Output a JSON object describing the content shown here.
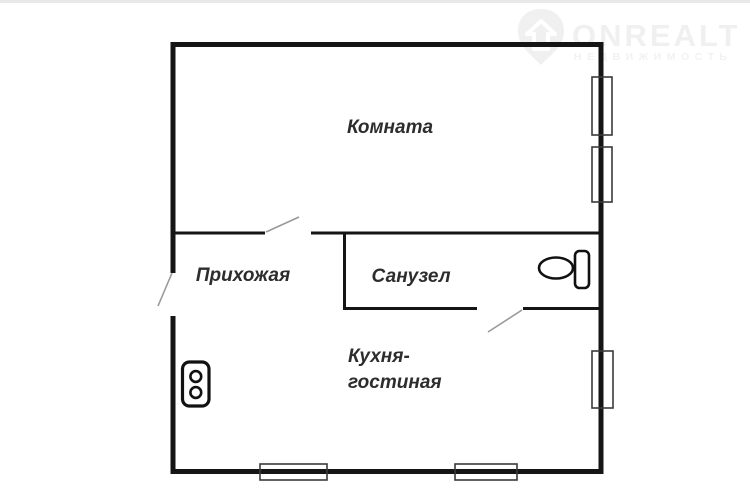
{
  "page": {
    "background": "#ffffff",
    "wall_color": "#151515",
    "door_leaf_color": "#999999",
    "window_outline_color": "#3a3a3a",
    "label_color": "#2d2d2d",
    "watermark_color": "#f0f0f0"
  },
  "watermark": {
    "brand": "ONREALT",
    "tagline": "НЕДВИЖИМОСТЬ",
    "icon": "shield-home-icon"
  },
  "floorplan": {
    "type": "apartment-floor-plan",
    "rooms": [
      {
        "id": "komnata",
        "label": "Комната"
      },
      {
        "id": "prihozhaya",
        "label": "Прихожая"
      },
      {
        "id": "sanuzel",
        "label": "Санузел"
      },
      {
        "id": "kitchen-living",
        "label_line1": "Кухня-",
        "label_line2": "гостиная"
      }
    ],
    "fixtures": [
      {
        "name": "toilet-icon",
        "room": "sanuzel"
      },
      {
        "name": "power-outlet-icon",
        "room": "kitchen-living"
      }
    ],
    "openings": {
      "doors": 3,
      "windows_right_wall": 3,
      "windows_bottom_wall": 2
    }
  }
}
